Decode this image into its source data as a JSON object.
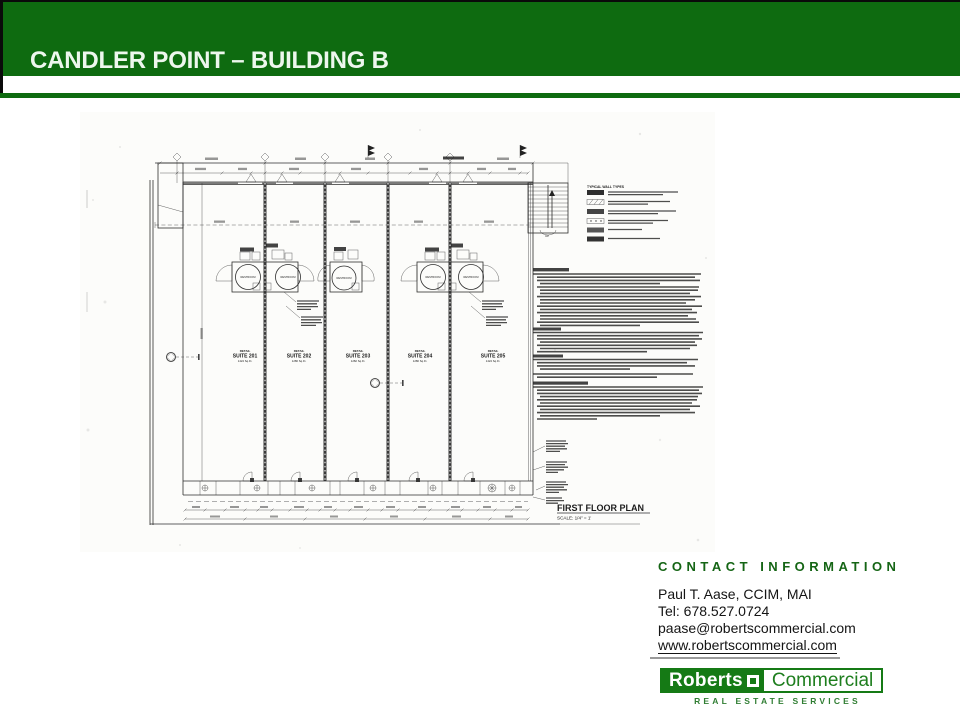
{
  "slide": {
    "title": "CANDLER POINT – BUILDING B"
  },
  "colors": {
    "header_green": "#0E6B10",
    "logo_green": "#157A15",
    "contact_heading_green": "#156515"
  },
  "floor_plan": {
    "title": "FIRST FLOOR PLAN",
    "scale_label": "SCALE: 1/4\" = 1'",
    "legend_title": "TYPICAL WALL TYPES",
    "stair_label": "UP",
    "restroom_label": "RESTROOM",
    "suites": [
      {
        "type_label": "RETAIL",
        "name": "SUITE 201",
        "area": "1424 Sq.Ft."
      },
      {
        "type_label": "RETAIL",
        "name": "SUITE 202",
        "area": "1280 Sq.Ft."
      },
      {
        "type_label": "RETAIL",
        "name": "SUITE 203",
        "area": "1282 Sq.Ft."
      },
      {
        "type_label": "RETAIL",
        "name": "SUITE 204",
        "area": "1280 Sq.Ft."
      },
      {
        "type_label": "RETAIL",
        "name": "SUITE 205",
        "area": "1424 Sq.Ft."
      }
    ]
  },
  "contact": {
    "heading": "CONTACT INFORMATION",
    "name": "Paul T. Aase, CCIM, MAI",
    "tel": "Tel:  678.527.0724",
    "email": "paase@robertscommercial.com",
    "website": "www.robertscommercial.com"
  },
  "logo": {
    "word1": "Roberts",
    "word2": "Commercial",
    "tagline": "REAL ESTATE SERVICES"
  }
}
